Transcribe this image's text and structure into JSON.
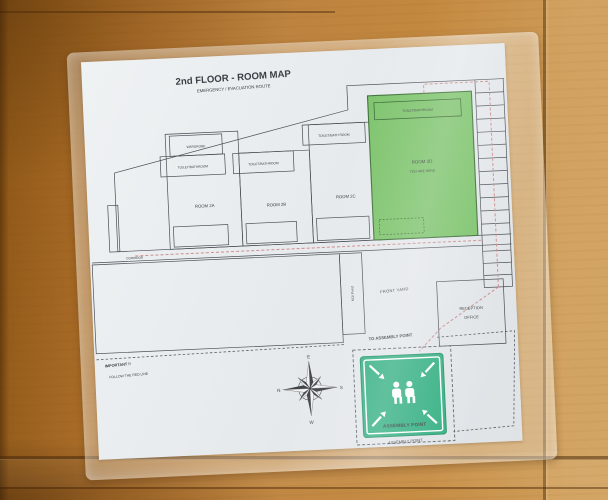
{
  "map": {
    "title": "2nd FLOOR - ROOM MAP",
    "subtitle": "EMERGENCY / EVACUATION ROUTE",
    "rooms": {
      "a": {
        "wardrobe_label": "WARDROBE",
        "bath_label": "TOILET/BATHROOM",
        "name": "ROOM 2A"
      },
      "b": {
        "bath_label": "TOILET/BATHROOM",
        "name": "ROOM 2B"
      },
      "c": {
        "bath_label": "TOILET/BATH ROOM",
        "name": "ROOM 2C"
      },
      "d": {
        "bath_label": "TOILET/BATHROOM",
        "name": "ROOM 2D",
        "note": "YOU ARE HERE"
      }
    },
    "corridor_label": "CORRIDOR",
    "koi_pond_label": "KOI Pond",
    "front_yard_label": "FRONT YARD",
    "reception_line1": "RECEPTION",
    "reception_line2": "OFFICE",
    "to_assembly_label": "TO ASSEMBLY POINT",
    "important_line1": "IMPORTANT !!",
    "important_line2": "FOLLOW THE RED LINE",
    "compass": {
      "top": "E",
      "left": "N",
      "right": "S",
      "bottom": "W"
    },
    "assembly_sign": {
      "sign_text": "ASSEMBLY POINT",
      "caption": "ASSEMBLY POINT"
    },
    "colors": {
      "highlight_room": "#7cc36b",
      "sign_green": "#35b083",
      "route_red": "#cf8f8f"
    }
  }
}
